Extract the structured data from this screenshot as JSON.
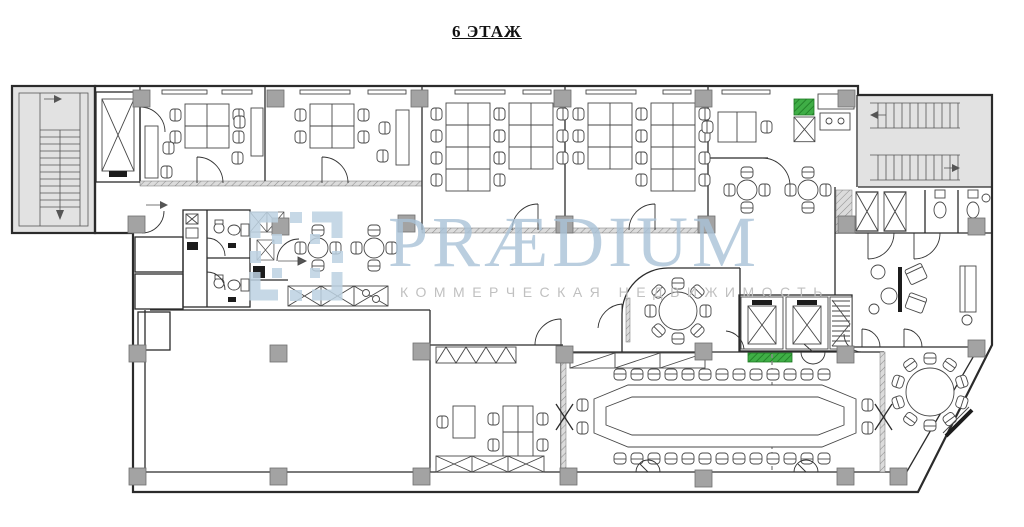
{
  "title": {
    "text": "6 ЭТАЖ"
  },
  "watermark": {
    "brand": "PRÆDIUM",
    "subtitle": "КОММЕРЧЕСКАЯ НЕДВИЖИМОСТЬ"
  },
  "colors": {
    "background": "#ffffff",
    "wall": "#2b2b2b",
    "furniture": "#474747",
    "stair_fill": "#e2e2e2",
    "column_fill": "#a3a3a3",
    "accent_green": "#3fae46",
    "wm_blue": "#aac3d8",
    "wm_gray": "#bdbdbd"
  }
}
